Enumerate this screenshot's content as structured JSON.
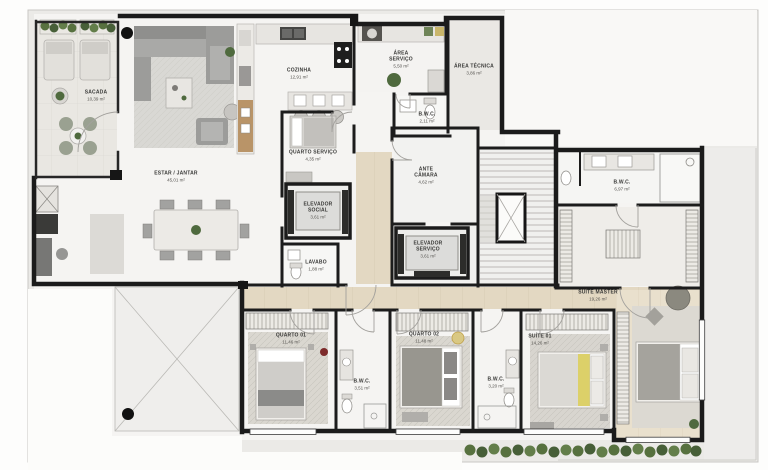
{
  "plan": {
    "type": "apartment-floor-plan",
    "language": "pt-BR",
    "area_unit": "m²"
  },
  "rooms": {
    "sacada": {
      "name": "SACADA",
      "area": "10,39 m²"
    },
    "estar_jantar": {
      "name": "ESTAR / JANTAR",
      "area": "45,01 m²"
    },
    "cozinha": {
      "name": "COZINHA",
      "area": "12,91 m²"
    },
    "area_servico": {
      "name": "ÁREA SERVIÇO",
      "area": "5,50 m²"
    },
    "area_tecnica": {
      "name": "ÁREA TÉCNICA",
      "area": "3,86 m²"
    },
    "bwc_servico": {
      "name": "B.W.C.",
      "area": "2,11 m²"
    },
    "quarto_servico": {
      "name": "QUARTO SERVIÇO",
      "area": "4,35 m²"
    },
    "elevador_social": {
      "name": "ELEVADOR SOCIAL",
      "area": "3,61 m²"
    },
    "ante_camara": {
      "name": "ANTE CÂMARA",
      "area": "4,62 m²"
    },
    "elevador_servico": {
      "name": "ELEVADOR SERVIÇO",
      "area": "3,61 m²"
    },
    "lavabo": {
      "name": "LAVABO",
      "area": "1,88 m²"
    },
    "quarto_01": {
      "name": "QUARTO 01",
      "area": "11,46 m²"
    },
    "bwc_01": {
      "name": "B.W.C.",
      "area": "3,51 m²"
    },
    "quarto_02": {
      "name": "QUARTO 02",
      "area": "11,48 m²"
    },
    "bwc_02": {
      "name": "B.W.C.",
      "area": "3,20 m²"
    },
    "suite_01": {
      "name": "SUÍTE 01",
      "area": "14,26 m²"
    },
    "suite_master": {
      "name": "SUÍTE MASTER",
      "area": "19,26 m²"
    },
    "bwc_master": {
      "name": "B.W.C.",
      "area": "6,97 m²"
    }
  },
  "colors": {
    "wall": "#1b1b1b",
    "floor": "#f5f4f2",
    "wood": "#e3d8c2",
    "plant_green": "#57713f",
    "accent_yellow": "#dcd069",
    "accent_red": "#7d2b2b"
  }
}
